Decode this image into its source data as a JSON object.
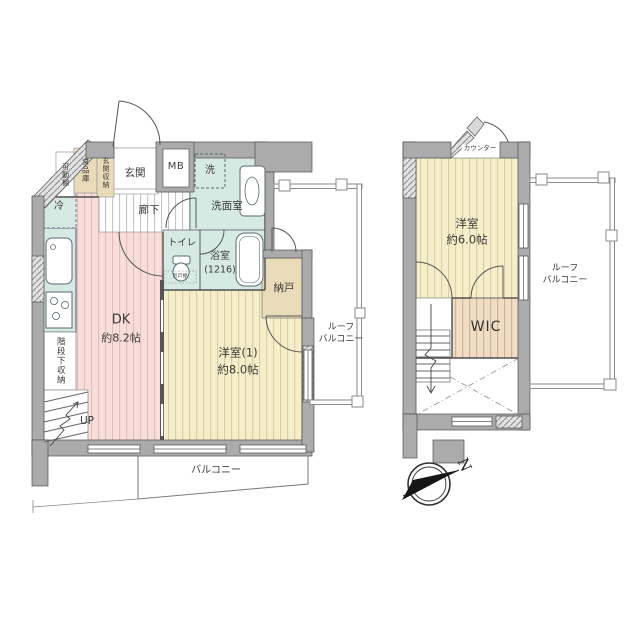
{
  "title": "マンション間取り図",
  "floor1": {
    "rooms": {
      "dk": {
        "name": "DK",
        "size": "約8.2帖"
      },
      "yoshitsu1": {
        "name": "洋室(1)",
        "size": "約8.0帖"
      },
      "genkan": "玄関",
      "mb": "MB",
      "rouka": "廊下",
      "senmenshitsu": "洗面室",
      "washer": "洗",
      "toilet": "トイレ",
      "hanging_cupboard": "吊戸棚",
      "bathroom": {
        "name": "浴室",
        "size": "(1216)"
      },
      "nando": "納戸",
      "fridge": "冷",
      "movable_shelf": "可動棚",
      "pantry": "食品庫",
      "genkan_storage": "玄関収納",
      "under_stair_storage": "階段下収納",
      "up": "UP",
      "balcony": "バルコニー",
      "roof_balcony_line1": "ルーフ",
      "roof_balcony_line2": "バルコニー"
    }
  },
  "floor2": {
    "rooms": {
      "yoshitsu": {
        "name": "洋室",
        "size": "約6.0帖"
      },
      "wic": "WIC",
      "counter": "カウンター",
      "roof_balcony_line1": "ルーフ",
      "roof_balcony_line2": "バルコニー"
    }
  },
  "compass": {
    "north_label": "N"
  },
  "colors": {
    "wall": "#ababab",
    "pink_floor": "#f8dedb",
    "cream_floor": "#f4eecb",
    "wic_floor": "#efddc6",
    "wet_area": "#d6eae4",
    "storage_tan": "#eadbb8"
  }
}
